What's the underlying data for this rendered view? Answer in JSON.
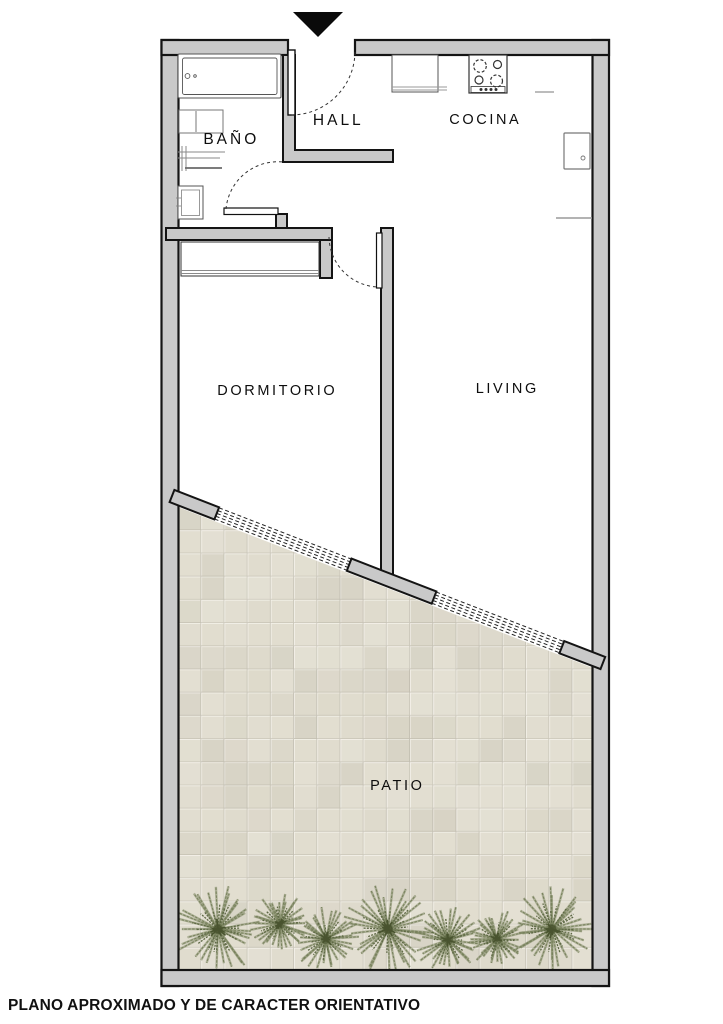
{
  "caption": {
    "text": "PLANO APROXIMADO Y DE CARACTER ORIENTATIVO"
  },
  "rooms": {
    "bano": {
      "label": "BAÑO"
    },
    "hall": {
      "label": "HALL"
    },
    "cocina": {
      "label": "COCINA"
    },
    "dormitorio": {
      "label": "DORMITORIO"
    },
    "living": {
      "label": "LIVING"
    },
    "patio": {
      "label": "PATIO"
    }
  },
  "icons": {
    "entrance_marker": "triangle-down-icon"
  },
  "colors": {
    "wall_fill": "#c9c9c9",
    "wall_line": "#141414",
    "fixture_line": "#555555",
    "tile": "#e1ddcf",
    "grout_light": "#f3f0e8",
    "grout_dark": "#c9c5b8",
    "plant": "#78825c",
    "plant_dark": "#5e6945",
    "plant_core": "#49542f"
  },
  "plants": [
    {
      "cx": 218,
      "cy": 929,
      "r": 43
    },
    {
      "cx": 280,
      "cy": 924,
      "r": 30
    },
    {
      "cx": 326,
      "cy": 939,
      "r": 33
    },
    {
      "cx": 388,
      "cy": 929,
      "r": 44
    },
    {
      "cx": 448,
      "cy": 940,
      "r": 33
    },
    {
      "cx": 497,
      "cy": 939,
      "r": 29
    },
    {
      "cx": 552,
      "cy": 929,
      "r": 41
    }
  ]
}
